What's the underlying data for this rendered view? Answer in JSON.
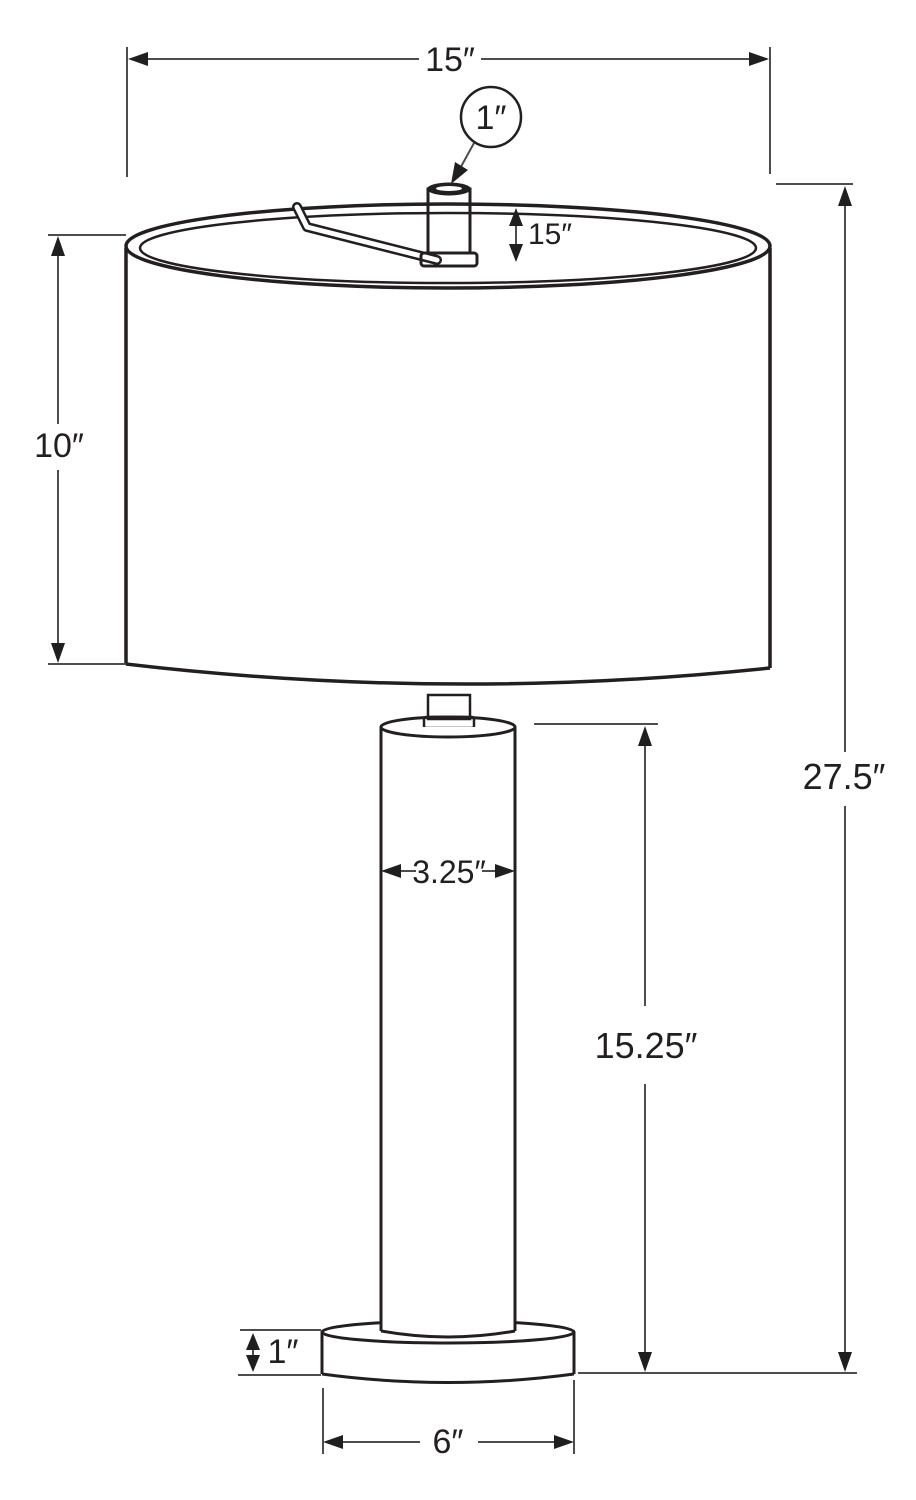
{
  "diagram": {
    "type": "product-dimension-diagram",
    "subject": "table lamp with drum shade, cylindrical pole and round base",
    "dimensions": {
      "shade_diameter": "15″",
      "finial_diameter": "1″",
      "rim_height": "15″",
      "shade_height": "10″",
      "total_height": "27.5″",
      "pole_diameter": "3.25″",
      "pole_height": "15.25″",
      "base_height": "1″",
      "base_diameter": "6″"
    },
    "colors": {
      "background": "#ffffff",
      "artwork_line": "#231f20",
      "dimension_line": "#4d4d4d",
      "arrowhead": "#1f1f1f",
      "text": "#231f20"
    }
  }
}
